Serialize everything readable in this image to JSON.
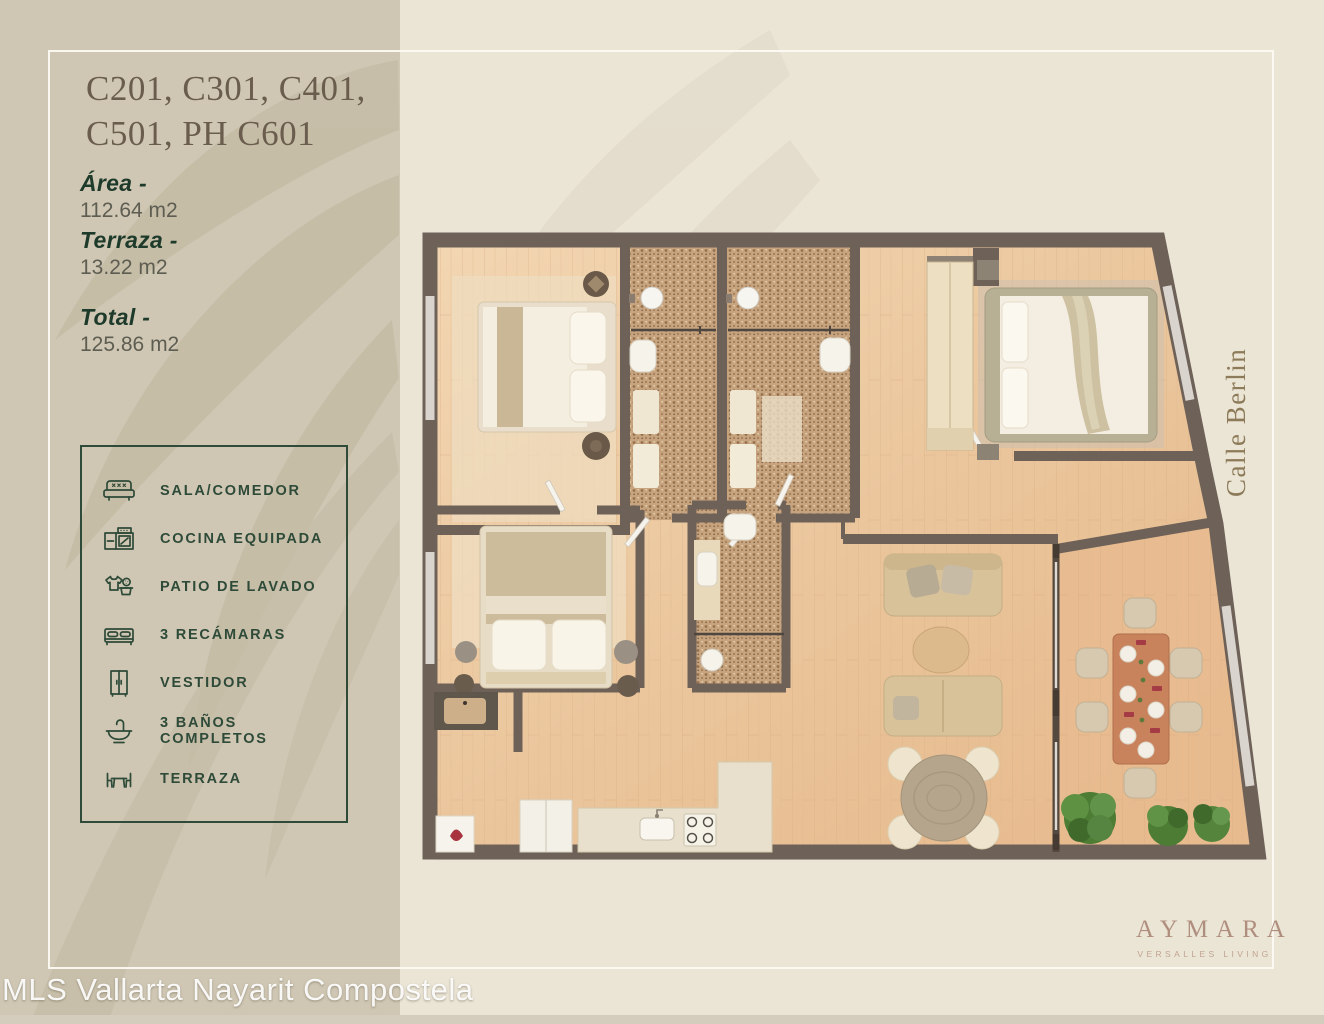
{
  "sidebar": {
    "title_line1": "C201, C301, C401,",
    "title_line2": "C501, PH C601",
    "measurements": [
      {
        "label": "Área -",
        "value": "112.64 m2"
      },
      {
        "label": "Terraza -",
        "value": "13.22 m2"
      },
      {
        "label": "Total -",
        "value": "125.86 m2"
      }
    ],
    "legend": {
      "items": [
        {
          "icon": "sofa-icon",
          "label": "SALA/COMEDOR"
        },
        {
          "icon": "kitchen-icon",
          "label": "COCINA EQUIPADA"
        },
        {
          "icon": "laundry-icon",
          "label": "PATIO DE LAVADO"
        },
        {
          "icon": "bed-icon",
          "label": "3 RECÁMARAS"
        },
        {
          "icon": "wardrobe-icon",
          "label": "VESTIDOR"
        },
        {
          "icon": "bathtub-icon",
          "label": "3 BAÑOS COMPLETOS"
        },
        {
          "icon": "terrace-icon",
          "label": "TERRAZA"
        }
      ]
    }
  },
  "floorplan": {
    "street_label": "Calle Berlin"
  },
  "branding": {
    "brand": "AYMARA",
    "tagline": "VERSALLES LIVING"
  },
  "watermark": {
    "text": "MLS Vallarta Nayarit Compostela"
  },
  "colors": {
    "sidebar_bg": "#cfc7b3",
    "main_bg": "#ebe5d6",
    "accent_green": "#2e4a38",
    "wall": "#6e6158",
    "wood_floor": "#eac49a",
    "brand_rose": "#b08e7e",
    "street_label_brown": "#8c7a58"
  }
}
